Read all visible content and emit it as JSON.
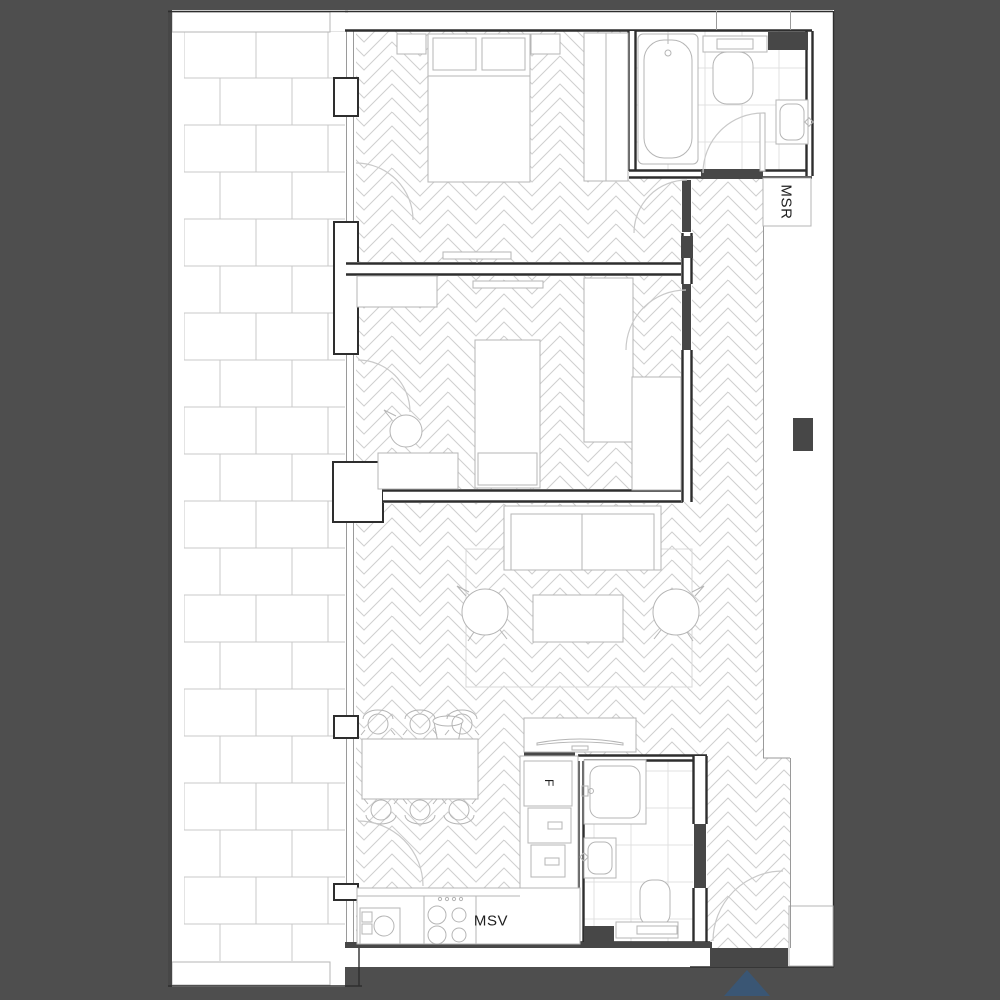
{
  "plan": {
    "type": "apartment-floor-plan",
    "labels": {
      "shaft_right": "MSR",
      "kitchen": "MSV",
      "fridge": "F"
    },
    "colors": {
      "background": "#4e4e4e",
      "paper": "#ffffff",
      "wall": "#2e2e2e",
      "dark_fill": "#474747",
      "furniture_line": "#b5b5b5",
      "pattern_line": "#cfcfcf",
      "brick_line": "#c9c9c9",
      "tile_line": "#e0e0e0",
      "label_text": "#1f1f1f",
      "entrance_arrow": "#3a5674"
    }
  }
}
